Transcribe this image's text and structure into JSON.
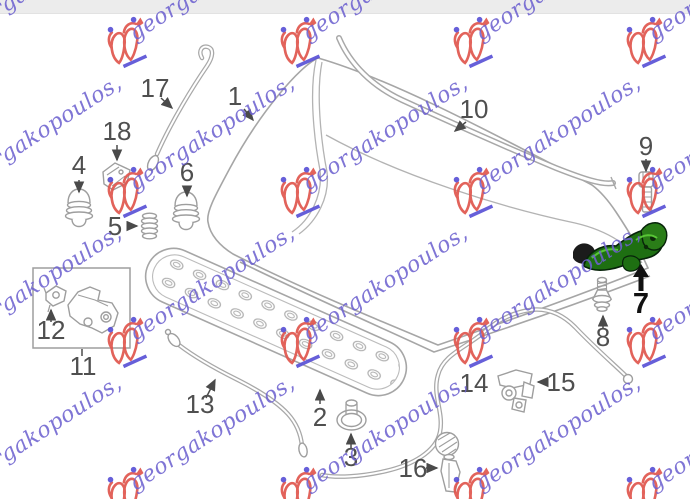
{
  "watermark": {
    "text": "georgakopoulos,",
    "text_color": "#6e62d0",
    "logo_color": "#e0564e",
    "accent_color": "#5a52d6"
  },
  "diagram": {
    "description": "Exploded parts diagram of a car hood (bonnet) assembly with numbered callouts; part 7 (hood hinge) is highlighted in green.",
    "line_color": "#a6a6a6",
    "label_color": "#4f4f4f",
    "highlight_part_color": "#1e6f12",
    "labels": {
      "p1": "1",
      "p2": "2",
      "p3": "3",
      "p4": "4",
      "p5": "5",
      "p6": "6",
      "p7": "7",
      "p8": "8",
      "p9": "9",
      "p10": "10",
      "p11": "11",
      "p12": "12",
      "p13": "13",
      "p14": "14",
      "p15": "15",
      "p16": "16",
      "p17": "17",
      "p18": "18"
    }
  }
}
